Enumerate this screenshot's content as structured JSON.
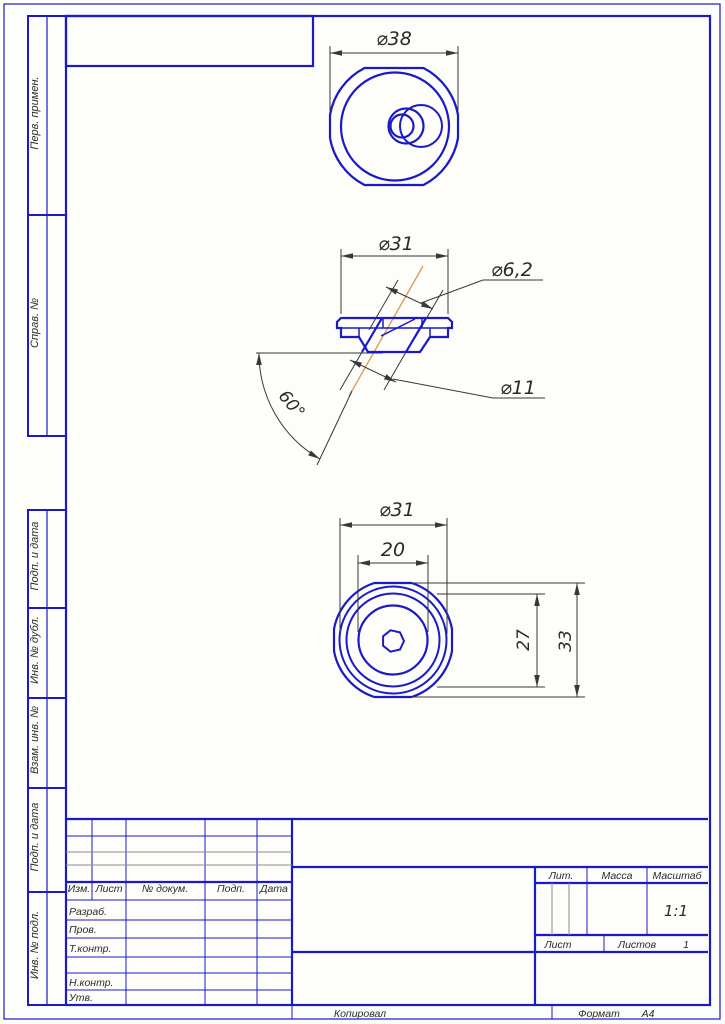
{
  "sheet": {
    "margin_labels": [
      "Перв. примен.",
      "Справ. №",
      "Подп. и дата",
      "Инв. № дубл.",
      "Взам. инв. №",
      "Подп. и дата",
      "Инв. № подл."
    ],
    "footer": {
      "copied_by": "Копировал",
      "format_label": "Формат",
      "format_value": "А4"
    }
  },
  "views": {
    "top": {
      "d38": "⌀38"
    },
    "section": {
      "d31": "⌀31",
      "d62": "⌀6,2",
      "d11": "⌀11",
      "angle": "60°"
    },
    "bottom": {
      "d31": "⌀31",
      "w20": "20",
      "h27": "27",
      "h33": "33"
    }
  },
  "title_block": {
    "change_cols": [
      "Изм.",
      "Лист",
      "№ докум.",
      "Подп.",
      "Дата"
    ],
    "sig_rows": [
      "Разраб.",
      "Пров.",
      "Т.контр.",
      "Н.контр.",
      "Утв."
    ],
    "lit_label": "Лит.",
    "mass_label": "Масса",
    "scale_label": "Масштаб",
    "scale_value": "1:1",
    "sheet_label": "Лист",
    "sheets_label": "Листов",
    "sheets_value": "1"
  },
  "colors": {
    "line_blue": "#1a1ac8",
    "dim_dark": "#383838",
    "centerline_orange": "#d89a50",
    "thin_gray": "#8c8c8c",
    "paper": "#fdfdfa"
  }
}
